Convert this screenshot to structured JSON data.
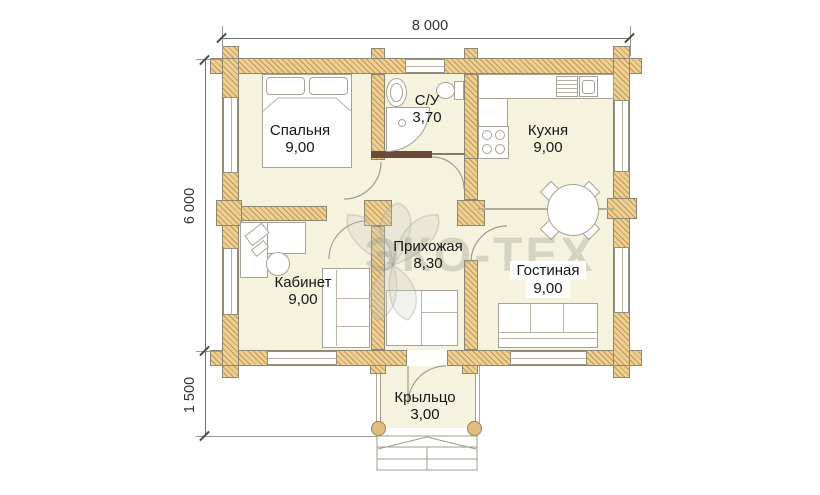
{
  "dimensions": {
    "width_total": "8 000",
    "height_main": "6 000",
    "height_porch": "1 500"
  },
  "rooms": {
    "bedroom": {
      "name": "Спальня",
      "area": "9,00"
    },
    "bathroom": {
      "name": "С/У",
      "area": "3,70"
    },
    "kitchen": {
      "name": "Кухня",
      "area": "9,00"
    },
    "office": {
      "name": "Кабинет",
      "area": "9,00"
    },
    "hallway": {
      "name": "Прихожая",
      "area": "8,30"
    },
    "living": {
      "name": "Гостиная",
      "area": "9,00"
    },
    "porch": {
      "name": "Крыльцо",
      "area": "3,00"
    }
  },
  "watermark": {
    "text": "ЭКО-ТЕХ"
  },
  "colors": {
    "wall_fill": "#ecd096",
    "wall_hatch": "#c29750",
    "floor": "#f5f2de",
    "dark_partition": "#6b4a3a",
    "label_text": "#161616",
    "dim_text": "#333333",
    "watermark_gray": "#d9d9d1"
  }
}
